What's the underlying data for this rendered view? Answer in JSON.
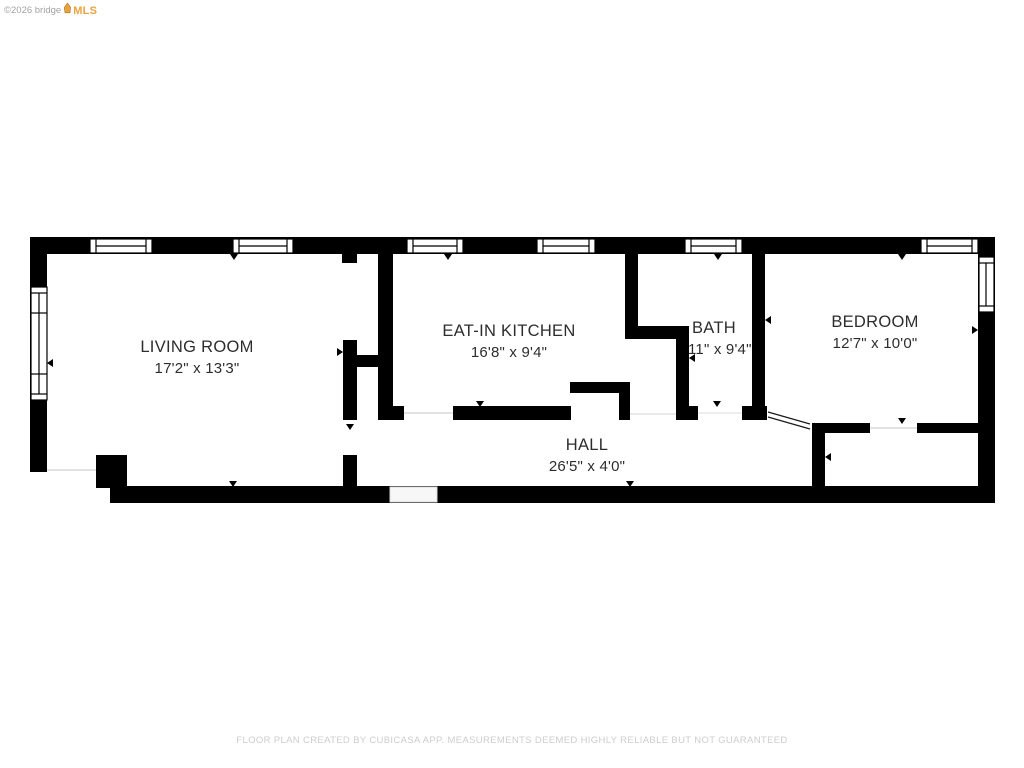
{
  "watermark": {
    "prefix": "©2026 bridge",
    "brand": "MLS",
    "icon": "flame-icon"
  },
  "rooms": [
    {
      "name": "LIVING ROOM",
      "dims": "17'2\" x 13'3\""
    },
    {
      "name": "EAT-IN KITCHEN",
      "dims": "16'8\" x 9'4\""
    },
    {
      "name": "BATH",
      "dims": "5'11\" x 9'4\""
    },
    {
      "name": "BEDROOM",
      "dims": "12'7\" x 10'0\""
    },
    {
      "name": "HALL",
      "dims": "26'5\" x 4'0\""
    }
  ],
  "footer": {
    "disclaimer": "FLOOR PLAN CREATED BY CUBICASA APP. MEASUREMENTS DEEMED HIGHLY RELIABLE BUT NOT GUARANTEED"
  },
  "colors": {
    "wall": "#000000",
    "brand_orange": "#E8A33C",
    "label_text": "#2d2d2d",
    "muted_text": "#cdcdcd"
  }
}
